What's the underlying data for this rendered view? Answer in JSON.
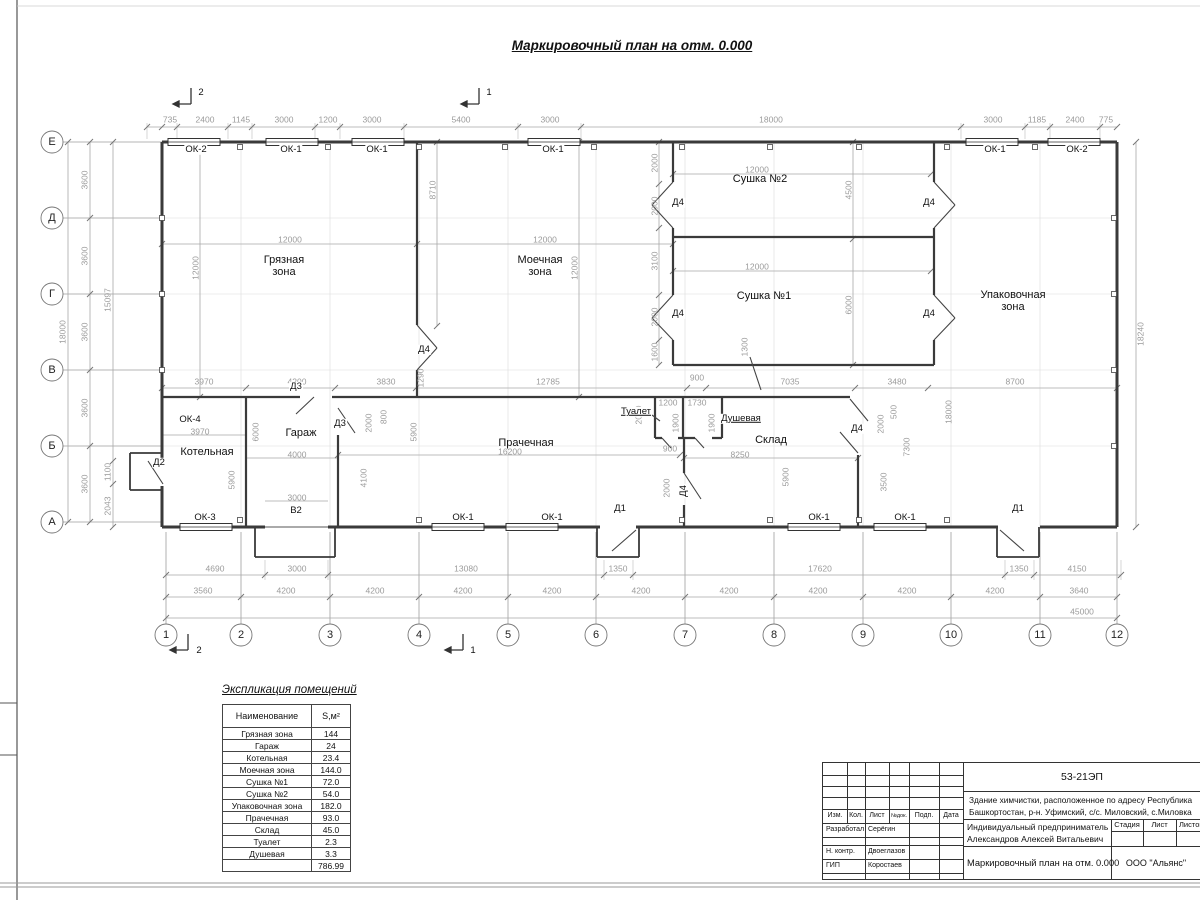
{
  "sheet": {
    "title": "Маркировочный план на отм. 0.000"
  },
  "plan": {
    "annotations": [
      {
        "t": "Е",
        "x": 52,
        "y": 142,
        "c": "axl"
      },
      {
        "t": "Д",
        "x": 52,
        "y": 218,
        "c": "axl"
      },
      {
        "t": "Г",
        "x": 52,
        "y": 294,
        "c": "axl"
      },
      {
        "t": "В",
        "x": 52,
        "y": 370,
        "c": "axl"
      },
      {
        "t": "Б",
        "x": 52,
        "y": 446,
        "c": "axl"
      },
      {
        "t": "А",
        "x": 52,
        "y": 522,
        "c": "axl"
      },
      {
        "t": "1",
        "x": 166,
        "y": 635,
        "c": "axl"
      },
      {
        "t": "2",
        "x": 241,
        "y": 635,
        "c": "axl"
      },
      {
        "t": "3",
        "x": 330,
        "y": 635,
        "c": "axl"
      },
      {
        "t": "4",
        "x": 419,
        "y": 635,
        "c": "axl"
      },
      {
        "t": "5",
        "x": 508,
        "y": 635,
        "c": "axl"
      },
      {
        "t": "6",
        "x": 596,
        "y": 635,
        "c": "axl"
      },
      {
        "t": "7",
        "x": 685,
        "y": 635,
        "c": "axl"
      },
      {
        "t": "8",
        "x": 774,
        "y": 635,
        "c": "axl"
      },
      {
        "t": "9",
        "x": 863,
        "y": 635,
        "c": "axl"
      },
      {
        "t": "10",
        "x": 951,
        "y": 635,
        "c": "axl"
      },
      {
        "t": "11",
        "x": 1040,
        "y": 635,
        "c": "axl"
      },
      {
        "t": "12",
        "x": 1117,
        "y": 635,
        "c": "axl"
      },
      {
        "t": "2",
        "x": 201,
        "y": 93,
        "c": "mark"
      },
      {
        "t": "1",
        "x": 489,
        "y": 93,
        "c": "mark"
      },
      {
        "t": "2",
        "x": 199,
        "y": 651,
        "c": "mark"
      },
      {
        "t": "1",
        "x": 473,
        "y": 651,
        "c": "mark"
      },
      {
        "t": "735",
        "x": 170,
        "y": 120
      },
      {
        "t": "2400",
        "x": 205,
        "y": 120
      },
      {
        "t": "1145",
        "x": 241,
        "y": 120
      },
      {
        "t": "3000",
        "x": 284,
        "y": 120
      },
      {
        "t": "1200",
        "x": 328,
        "y": 120
      },
      {
        "t": "3000",
        "x": 372,
        "y": 120
      },
      {
        "t": "5400",
        "x": 461,
        "y": 120
      },
      {
        "t": "3000",
        "x": 550,
        "y": 120
      },
      {
        "t": "18000",
        "x": 771,
        "y": 120
      },
      {
        "t": "3000",
        "x": 993,
        "y": 120
      },
      {
        "t": "1185",
        "x": 1037,
        "y": 120
      },
      {
        "t": "2400",
        "x": 1075,
        "y": 120
      },
      {
        "t": "775",
        "x": 1106,
        "y": 120
      },
      {
        "t": "4690",
        "x": 215,
        "y": 569
      },
      {
        "t": "3000",
        "x": 297,
        "y": 569
      },
      {
        "t": "13080",
        "x": 466,
        "y": 569
      },
      {
        "t": "1350",
        "x": 618,
        "y": 569
      },
      {
        "t": "17620",
        "x": 820,
        "y": 569
      },
      {
        "t": "1350",
        "x": 1019,
        "y": 569
      },
      {
        "t": "4150",
        "x": 1077,
        "y": 569
      },
      {
        "t": "3560",
        "x": 203,
        "y": 591
      },
      {
        "t": "4200",
        "x": 286,
        "y": 591
      },
      {
        "t": "4200",
        "x": 375,
        "y": 591
      },
      {
        "t": "4200",
        "x": 463,
        "y": 591
      },
      {
        "t": "4200",
        "x": 552,
        "y": 591
      },
      {
        "t": "4200",
        "x": 641,
        "y": 591
      },
      {
        "t": "4200",
        "x": 729,
        "y": 591
      },
      {
        "t": "4200",
        "x": 818,
        "y": 591
      },
      {
        "t": "4200",
        "x": 907,
        "y": 591
      },
      {
        "t": "4200",
        "x": 995,
        "y": 591
      },
      {
        "t": "3640",
        "x": 1079,
        "y": 591
      },
      {
        "t": "45000",
        "x": 1082,
        "y": 612
      },
      {
        "t": "18000",
        "x": 63,
        "y": 332,
        "r": 1
      },
      {
        "t": "3600",
        "x": 85,
        "y": 180,
        "r": 1
      },
      {
        "t": "3600",
        "x": 85,
        "y": 256,
        "r": 1
      },
      {
        "t": "3600",
        "x": 85,
        "y": 332,
        "r": 1
      },
      {
        "t": "3600",
        "x": 85,
        "y": 408,
        "r": 1
      },
      {
        "t": "3600",
        "x": 85,
        "y": 484,
        "r": 1
      },
      {
        "t": "15097",
        "x": 108,
        "y": 300,
        "r": 1
      },
      {
        "t": "1100",
        "x": 108,
        "y": 472,
        "r": 1
      },
      {
        "t": "2043",
        "x": 108,
        "y": 506,
        "r": 1
      },
      {
        "t": "18240",
        "x": 1141,
        "y": 334,
        "r": 1
      },
      {
        "t": "12000",
        "x": 290,
        "y": 240
      },
      {
        "t": "12000",
        "x": 196,
        "y": 268,
        "r": 1
      },
      {
        "t": "8710",
        "x": 433,
        "y": 190,
        "r": 1
      },
      {
        "t": "12000",
        "x": 545,
        "y": 240
      },
      {
        "t": "12000",
        "x": 575,
        "y": 268,
        "r": 1
      },
      {
        "t": "1290",
        "x": 421,
        "y": 378,
        "r": 1
      },
      {
        "t": "3970",
        "x": 204,
        "y": 382
      },
      {
        "t": "4200",
        "x": 297,
        "y": 382
      },
      {
        "t": "3830",
        "x": 386,
        "y": 382
      },
      {
        "t": "12785",
        "x": 548,
        "y": 382
      },
      {
        "t": "900",
        "x": 697,
        "y": 378
      },
      {
        "t": "7035",
        "x": 790,
        "y": 382
      },
      {
        "t": "3480",
        "x": 897,
        "y": 382
      },
      {
        "t": "8700",
        "x": 1015,
        "y": 382
      },
      {
        "t": "12000",
        "x": 757,
        "y": 170
      },
      {
        "t": "4500",
        "x": 849,
        "y": 190,
        "r": 1
      },
      {
        "t": "12000",
        "x": 757,
        "y": 267
      },
      {
        "t": "6000",
        "x": 849,
        "y": 305,
        "r": 1
      },
      {
        "t": "1300",
        "x": 745,
        "y": 347,
        "r": 1
      },
      {
        "t": "2000",
        "x": 655,
        "y": 163,
        "r": 1
      },
      {
        "t": "2000",
        "x": 655,
        "y": 206,
        "r": 1
      },
      {
        "t": "3100",
        "x": 655,
        "y": 261,
        "r": 1
      },
      {
        "t": "2000",
        "x": 655,
        "y": 317,
        "r": 1
      },
      {
        "t": "1600",
        "x": 655,
        "y": 352,
        "r": 1
      },
      {
        "t": "3970",
        "x": 200,
        "y": 432
      },
      {
        "t": "6000",
        "x": 256,
        "y": 432,
        "r": 1
      },
      {
        "t": "5900",
        "x": 232,
        "y": 480,
        "r": 1
      },
      {
        "t": "4000",
        "x": 297,
        "y": 455
      },
      {
        "t": "4100",
        "x": 364,
        "y": 478,
        "r": 1
      },
      {
        "t": "3000",
        "x": 297,
        "y": 498
      },
      {
        "t": "2000",
        "x": 369,
        "y": 423,
        "r": 1
      },
      {
        "t": "800",
        "x": 384,
        "y": 417,
        "r": 1
      },
      {
        "t": "5900",
        "x": 414,
        "y": 432,
        "r": 1
      },
      {
        "t": "16200",
        "x": 510,
        "y": 452
      },
      {
        "t": "2000",
        "x": 639,
        "y": 415,
        "r": 1
      },
      {
        "t": "1200",
        "x": 668,
        "y": 403
      },
      {
        "t": "1730",
        "x": 697,
        "y": 403
      },
      {
        "t": "1900",
        "x": 676,
        "y": 423,
        "r": 1
      },
      {
        "t": "1900",
        "x": 712,
        "y": 423,
        "r": 1
      },
      {
        "t": "900",
        "x": 670,
        "y": 449
      },
      {
        "t": "2000",
        "x": 667,
        "y": 488,
        "r": 1
      },
      {
        "t": "8250",
        "x": 740,
        "y": 455
      },
      {
        "t": "5900",
        "x": 786,
        "y": 477,
        "r": 1
      },
      {
        "t": "2000",
        "x": 881,
        "y": 424,
        "r": 1
      },
      {
        "t": "500",
        "x": 894,
        "y": 412,
        "r": 1
      },
      {
        "t": "7300",
        "x": 907,
        "y": 447,
        "r": 1
      },
      {
        "t": "18000",
        "x": 949,
        "y": 412,
        "r": 1
      },
      {
        "t": "3500",
        "x": 884,
        "y": 482,
        "r": 1
      },
      {
        "t": "ОК-2",
        "x": 196,
        "y": 150,
        "c": "mark"
      },
      {
        "t": "ОК-1",
        "x": 291,
        "y": 150,
        "c": "mark"
      },
      {
        "t": "ОК-1",
        "x": 377,
        "y": 150,
        "c": "mark"
      },
      {
        "t": "ОК-1",
        "x": 553,
        "y": 150,
        "c": "mark"
      },
      {
        "t": "ОК-1",
        "x": 995,
        "y": 150,
        "c": "mark"
      },
      {
        "t": "ОК-2",
        "x": 1077,
        "y": 150,
        "c": "mark"
      },
      {
        "t": "ОК-4",
        "x": 190,
        "y": 420,
        "c": "mark"
      },
      {
        "t": "ОК-3",
        "x": 205,
        "y": 518,
        "c": "mark"
      },
      {
        "t": "ОК-1",
        "x": 463,
        "y": 518,
        "c": "mark"
      },
      {
        "t": "ОК-1",
        "x": 552,
        "y": 518,
        "c": "mark"
      },
      {
        "t": "ОК-1",
        "x": 819,
        "y": 518,
        "c": "mark"
      },
      {
        "t": "ОК-1",
        "x": 905,
        "y": 518,
        "c": "mark"
      },
      {
        "t": "Д2",
        "x": 159,
        "y": 463,
        "c": "mark"
      },
      {
        "t": "Д3",
        "x": 296,
        "y": 387,
        "c": "mark"
      },
      {
        "t": "Д3",
        "x": 340,
        "y": 424,
        "c": "mark"
      },
      {
        "t": "Д4",
        "x": 424,
        "y": 350,
        "c": "mark"
      },
      {
        "t": "Д4",
        "x": 678,
        "y": 203,
        "c": "mark"
      },
      {
        "t": "Д4",
        "x": 929,
        "y": 203,
        "c": "mark"
      },
      {
        "t": "Д4",
        "x": 678,
        "y": 314,
        "c": "mark"
      },
      {
        "t": "Д4",
        "x": 929,
        "y": 314,
        "c": "mark"
      },
      {
        "t": "Д4",
        "x": 857,
        "y": 429,
        "c": "mark"
      },
      {
        "t": "Д4",
        "x": 684,
        "y": 491,
        "c": "mark",
        "r": 1
      },
      {
        "t": "Д1",
        "x": 620,
        "y": 509,
        "c": "mark"
      },
      {
        "t": "Д1",
        "x": 1018,
        "y": 509,
        "c": "mark"
      },
      {
        "t": "В2",
        "x": 296,
        "y": 511,
        "c": "mark"
      },
      {
        "t": "Туалет",
        "x": 636,
        "y": 412,
        "c": "mark u"
      },
      {
        "t": "Душевая",
        "x": 741,
        "y": 419,
        "c": "mark u"
      },
      {
        "t": "Грязная\nзона",
        "x": 284,
        "y": 266,
        "c": "room"
      },
      {
        "t": "Моечная\nзона",
        "x": 540,
        "y": 266,
        "c": "room"
      },
      {
        "t": "Сушка №2",
        "x": 760,
        "y": 179,
        "c": "room"
      },
      {
        "t": "Сушка №1",
        "x": 764,
        "y": 296,
        "c": "room"
      },
      {
        "t": "Упаковочная\nзона",
        "x": 1013,
        "y": 301,
        "c": "room"
      },
      {
        "t": "Котельная",
        "x": 207,
        "y": 452,
        "c": "room"
      },
      {
        "t": "Гараж",
        "x": 301,
        "y": 433,
        "c": "room"
      },
      {
        "t": "Прачечная",
        "x": 526,
        "y": 443,
        "c": "room"
      },
      {
        "t": "Склад",
        "x": 771,
        "y": 440,
        "c": "room"
      }
    ]
  },
  "explication": {
    "title": "Экспликация помещений",
    "headers": [
      "Наименование",
      "S,м²"
    ],
    "rows": [
      [
        "Грязная зона",
        "144"
      ],
      [
        "Гараж",
        "24"
      ],
      [
        "Котельная",
        "23.4"
      ],
      [
        "Моечная зона",
        "144.0"
      ],
      [
        "Сушка №1",
        "72.0"
      ],
      [
        "Сушка №2",
        "54.0"
      ],
      [
        "Упаковочная зона",
        "182.0"
      ],
      [
        "Прачечная",
        "93.0"
      ],
      [
        "Склад",
        "45.0"
      ],
      [
        "Туалет",
        "2.3"
      ],
      [
        "Душевая",
        "3.3"
      ],
      [
        "",
        "786.99"
      ]
    ]
  },
  "titleblock": {
    "doc_number": "53-21ЭП",
    "object_line1": "Здание химчистки,  расположенное по адресу Республика",
    "object_line2": "Башкортостан, р-н. Уфимский, с/с. Миловский, с.Миловка",
    "client_line1": "Индивидуальный предприниматель",
    "client_line2": "Александров Алексей Витальевич",
    "sheet_title": "Маркировочный план на отм. 0.000",
    "company": "ООО \"Альянс\"",
    "stage_label": "Стадия",
    "sheet_label": "Лист",
    "sheets_label": "Листов",
    "header_cols": [
      "Изм.",
      "Кол.",
      "Лист",
      "№док.",
      "Подп.",
      "Дата"
    ],
    "sig_rows": [
      {
        "role": "Разработал",
        "name": "Серёгин"
      },
      {
        "role": "Н. контр.",
        "name": "Двоеглазов"
      },
      {
        "role": "ГИП",
        "name": "Коростаев"
      }
    ]
  }
}
